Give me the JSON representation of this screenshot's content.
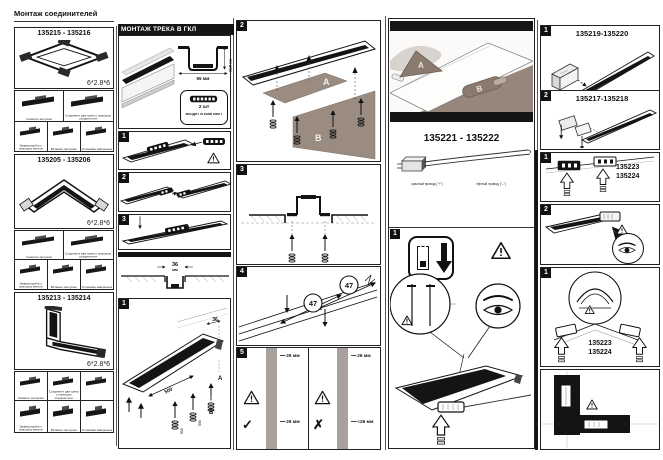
{
  "page": {
    "title": "Монтаж соединителей"
  },
  "connector_sections": [
    {
      "code": "135215 - 135216",
      "spec": "6*2.8*6",
      "captions": [
        "Снимите заглушки",
        "Соедините два трека с помощью соединителя",
        "Зафиксируйте с помощью винтов",
        "Вставьте заглушки",
        "Установка завершена"
      ]
    },
    {
      "code": "135205 - 135206",
      "spec": "6*2.8*6",
      "captions": [
        "Снимите заглушки",
        "Соедините два трека с помощью соединителя",
        "Зафиксируйте с помощью винтов",
        "Вставьте заглушки",
        "Установка завершена"
      ]
    },
    {
      "code": "135213 - 135214",
      "spec": "6*2.8*6",
      "captions": [
        "Снимите заглушки",
        "Соедините два трека с помощью соединителя",
        "Зафиксируйте с помощью винтов",
        "Вставьте заглушки",
        "Установка завершена"
      ]
    }
  ],
  "track_mount": {
    "header": "МОНТАЖ ТРЕКА В ГКЛ",
    "profile_width": "65 мм",
    "profile_height": "31.5 мм",
    "kit_qty": "2 шт",
    "kit_note": "ВХОДИТ В КОМПЛЕКТ",
    "step1": "1",
    "step2": "2",
    "step3": "3",
    "slot_width_value": "36",
    "slot_width_unit": "мм",
    "install": {
      "step": "1",
      "spacing": "500",
      "width": "36",
      "label_a": "A",
      "label_b": "B"
    }
  },
  "ceiling": {
    "step2": "2",
    "label_a": "A",
    "label_b": "B",
    "step3": "3",
    "step4": "4",
    "screw_spacing": "47",
    "step5": "5",
    "ok_top": "26 мм",
    "ok_bottom": "26 мм",
    "check": "✓",
    "bad_top": "26 мм",
    "bad_bottom": "<26 мм",
    "cross": "✗"
  },
  "power": {
    "code": "135221 - 135222",
    "wire_red": "красный провод (\"+\")",
    "wire_black": "чёрный провод (\"–\")",
    "step": "1"
  },
  "right_col": {
    "p1": {
      "num": "1",
      "code": "135219-135220"
    },
    "p2": {
      "num": "2",
      "code": "135217-135218"
    },
    "p3": {
      "num": "1",
      "code_line1": "135223",
      "code_line2": "135224"
    },
    "p4": {
      "num": "2"
    },
    "p5": {
      "num": "1",
      "code_line1": "135223",
      "code_line2": "135224"
    }
  }
}
